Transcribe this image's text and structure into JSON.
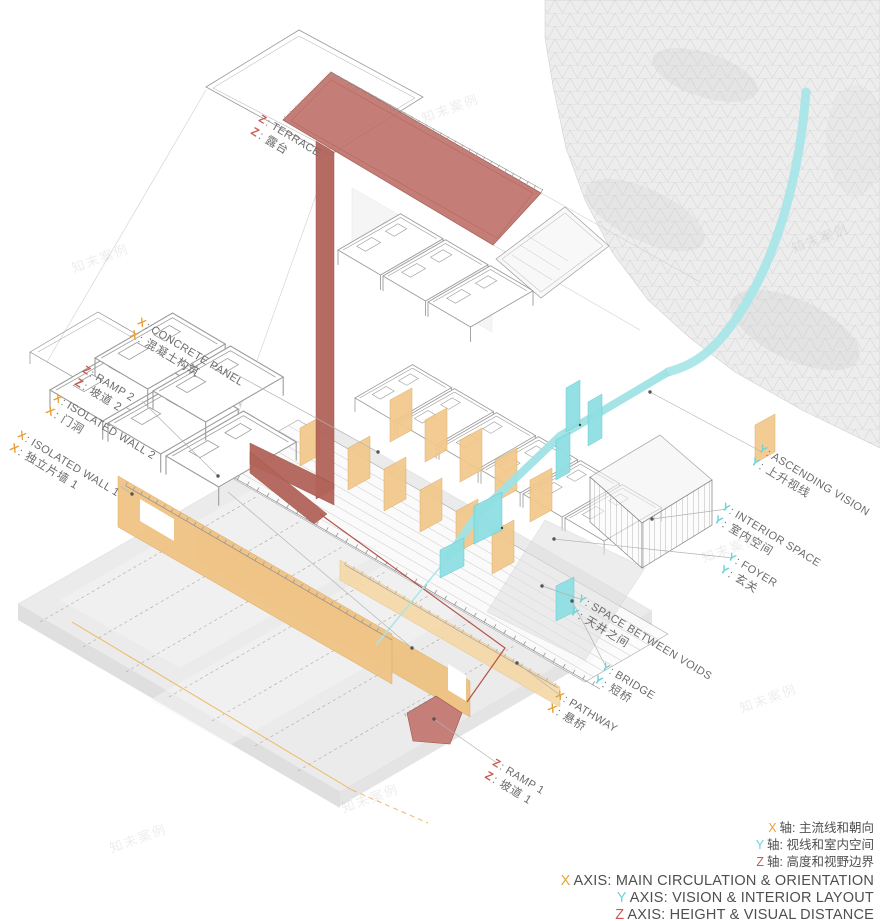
{
  "watermark": "知末案例",
  "colors": {
    "axis_x": "#E6A23C",
    "axis_y": "#6ED3D9",
    "axis_z": "#C75B50",
    "terrace_red": "#C1736C",
    "wall_orange": "#F0C486",
    "vision_cyan": "#A9E6E8"
  },
  "labels": {
    "terrace": {
      "axis": "Z",
      "en": ": TERRACE",
      "cn": ": 露台"
    },
    "concrete_panel": {
      "axis": "X",
      "en": ": CONCRETE PANEL",
      "cn": ": 混凝土构筑"
    },
    "ramp_2": {
      "axis": "Z",
      "en": ": RAMP 2",
      "cn": ": 坡道 2"
    },
    "isolated_wall_2": {
      "axis": "X",
      "en": ": ISOLATED WALL 2",
      "cn": ": 门洞"
    },
    "isolated_wall_1": {
      "axis": "X",
      "en": ": ISOLATED WALL 1",
      "cn": ": 独立片墙 1"
    },
    "ascending_vision": {
      "axis": "Y",
      "en": ": ASCENDING VISION",
      "cn": ": 上升视线"
    },
    "interior_space": {
      "axis": "Y",
      "en": ": INTERIOR SPACE",
      "cn": ": 室内空间"
    },
    "foyer": {
      "axis": "Y",
      "en": ": FOYER",
      "cn": ": 玄关"
    },
    "space_between_voids": {
      "axis": "Y",
      "en": ": SPACE BETWEEN VOIDS",
      "cn": ": 天井之间"
    },
    "bridge": {
      "axis": "Y",
      "en": ": BRIDGE",
      "cn": ": 短桥"
    },
    "pathway": {
      "axis": "X",
      "en": ": PATHWAY",
      "cn": ": 悬桥"
    },
    "ramp_1": {
      "axis": "Z",
      "en": ": RAMP 1",
      "cn": ": 坡道 1"
    }
  },
  "legend": {
    "cn": [
      {
        "axis": "X",
        "text": "轴: 主流线和朝向"
      },
      {
        "axis": "Y",
        "text": "轴: 视线和室内空间"
      },
      {
        "axis": "Z",
        "text": "轴: 高度和视野边界"
      }
    ],
    "en": [
      {
        "axis": "X",
        "text": "AXIS: MAIN CIRCULATION & ORIENTATION"
      },
      {
        "axis": "Y",
        "text": "AXIS: VISION & INTERIOR LAYOUT"
      },
      {
        "axis": "Z",
        "text": "AXIS: HEIGHT & VISUAL DISTANCE"
      }
    ]
  }
}
